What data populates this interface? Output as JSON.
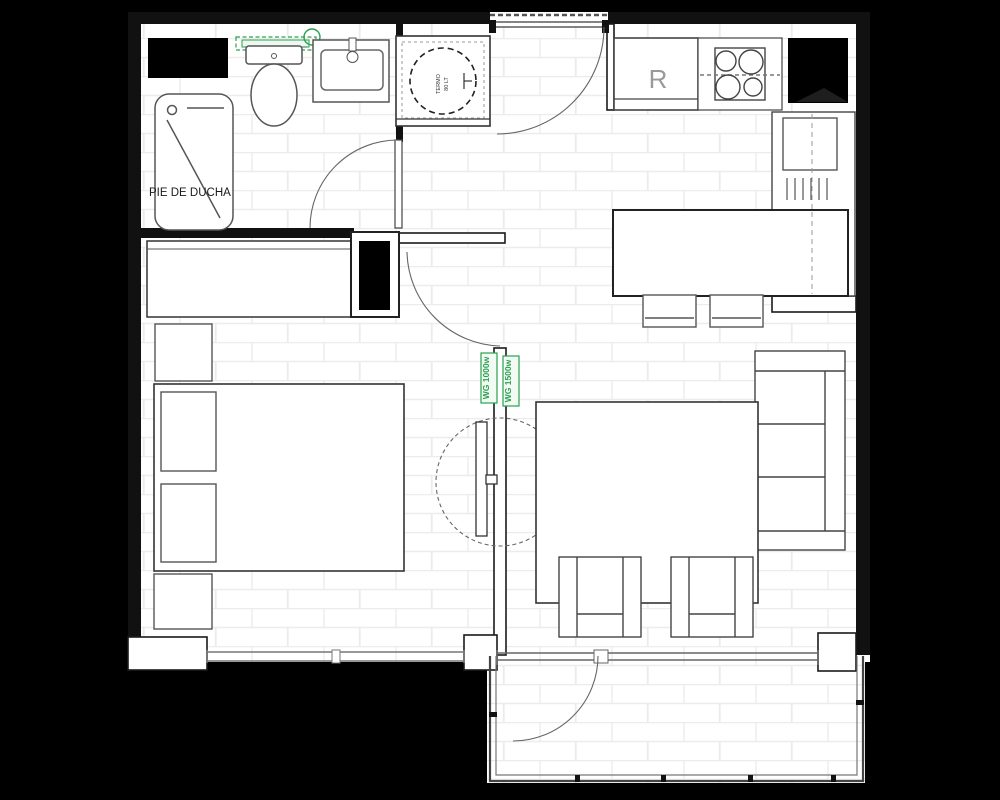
{
  "title": "apartment-floor-plan",
  "labels": {
    "shower_tray": "PIE DE DUCHA",
    "fridge": "R",
    "water_heater_line1": "TERMO",
    "water_heater_line2": "80 LT",
    "heater_left": "WG 1000w",
    "heater_right": "WG 1500w"
  },
  "colors": {
    "background": "#000000",
    "wall": "#111111",
    "floor": "#ffffff",
    "brick_line": "#ececec",
    "furniture_stroke": "#555555",
    "accent_green": "#2aa14e",
    "fridge_gray": "#9a9a9a"
  }
}
